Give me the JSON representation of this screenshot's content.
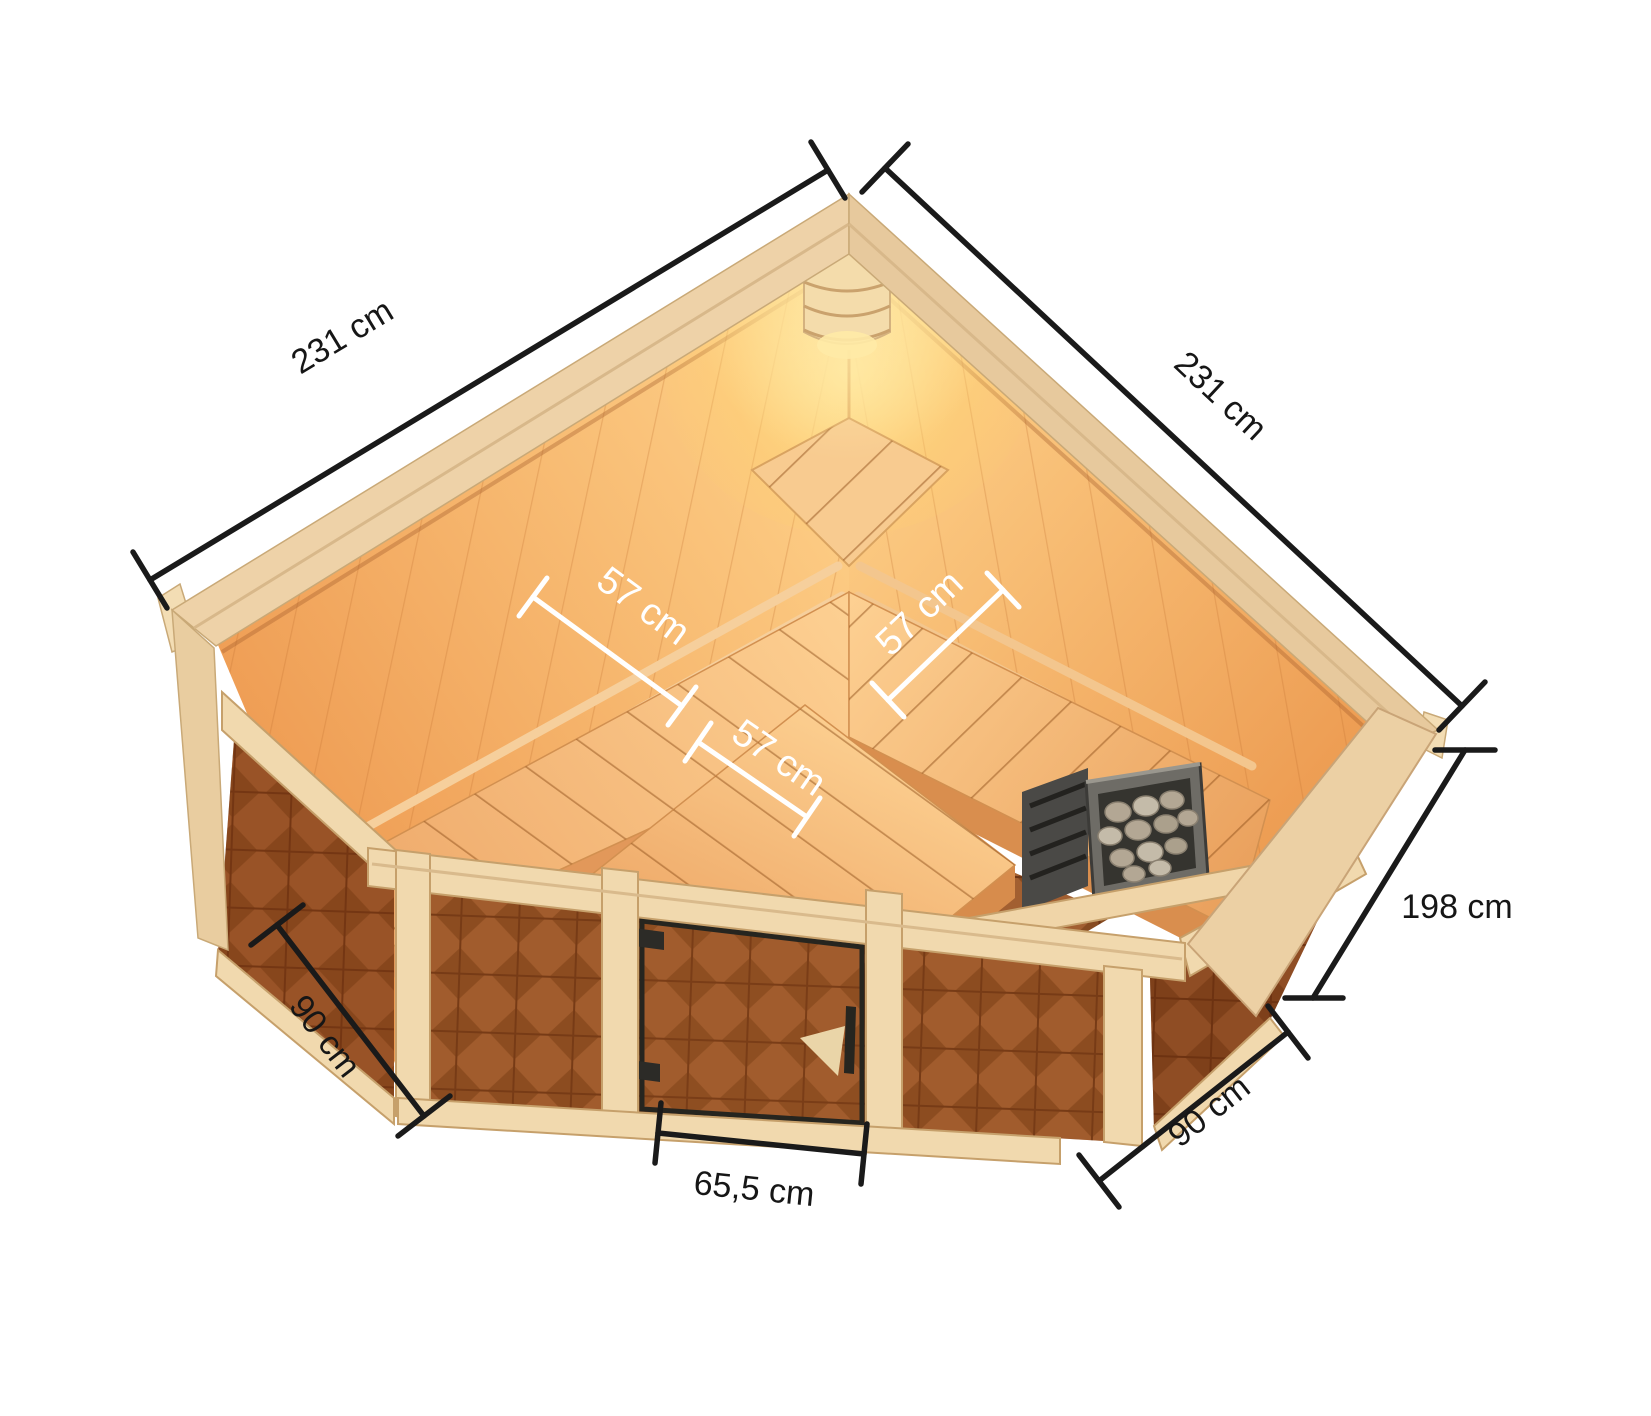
{
  "diagram": {
    "kind": "sauna-dimension-drawing",
    "view": "corner sauna, top interior view",
    "dimensions": {
      "wall_left": "231 cm",
      "wall_right": "231 cm",
      "height": "198 cm",
      "front_left": "90 cm",
      "front_right": "90 cm",
      "door_width": "65,5 cm",
      "bench_left_depth": "57 cm",
      "bench_right_depth": "57 cm",
      "bench_front_depth": "57 cm"
    },
    "colors": {
      "background": "#ffffff",
      "dimension_line": "#1a1a1a",
      "interior_dimension_line": "#ffffff",
      "frame_wood": "#f2dcb4",
      "interior_glow": "#ffd98f",
      "interior_wall": "#f2a55c",
      "bench_wood": "#f6ba7c",
      "glass_tint": "#8a5130",
      "floor_tile": "#9a5c33",
      "heater_body": "#55544f",
      "heater_stones": "#b2a897"
    }
  }
}
